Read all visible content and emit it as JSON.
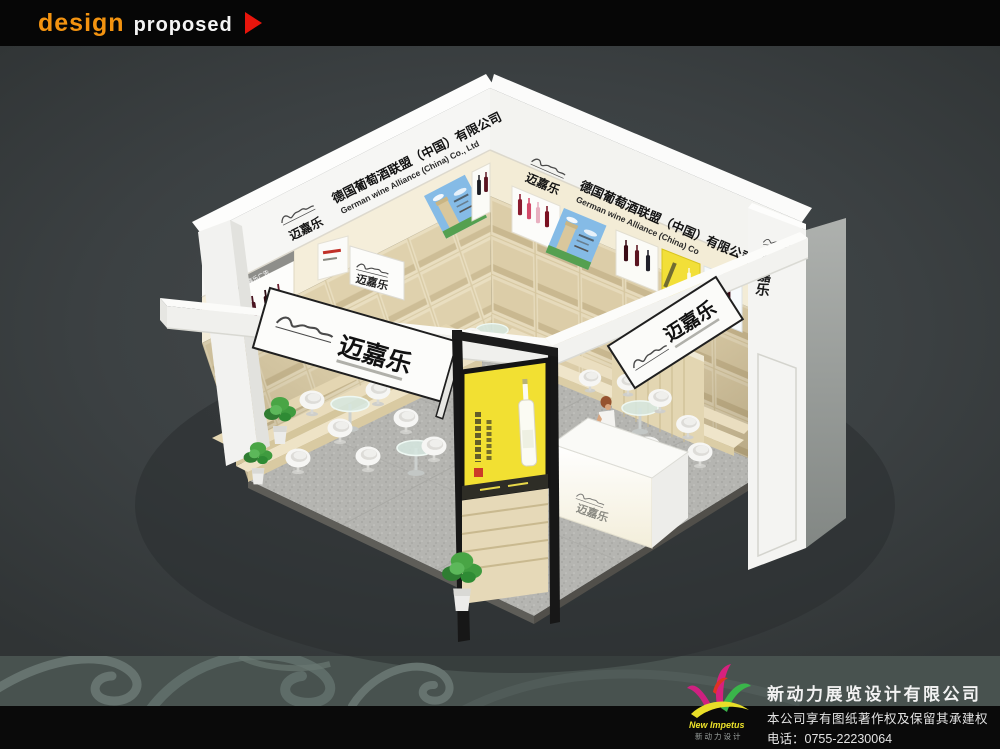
{
  "header": {
    "brand": "design",
    "status": "proposed"
  },
  "booth": {
    "brand": "迈嘉乐",
    "company_cn": "德国葡萄酒联盟（中国）有限公司",
    "company_en_left": "German wine Alliance (China) Co., Ltd",
    "company_en_right": "German wine Alliance (China) Co",
    "poster_header": "迈嘉乐广告"
  },
  "footer": {
    "logo_en": "New Impetus",
    "logo_cn": "新动力设计",
    "company": "新动力展览设计有限公司",
    "rights": "本公司享有图纸著作权及保留其承建权",
    "phone_label": "电话：",
    "phone1": "0755-22230064",
    "phone2": "0755-22230067"
  },
  "colors": {
    "accent_orange": "#f39310",
    "accent_red": "#e8150c",
    "bg_dark": "#3a3f41",
    "wood": "#e9dec0",
    "lightbox_yellow": "#f2e032",
    "logo_magenta": "#d6217e",
    "logo_green": "#3ab54a",
    "logo_yellow": "#e8de28"
  }
}
